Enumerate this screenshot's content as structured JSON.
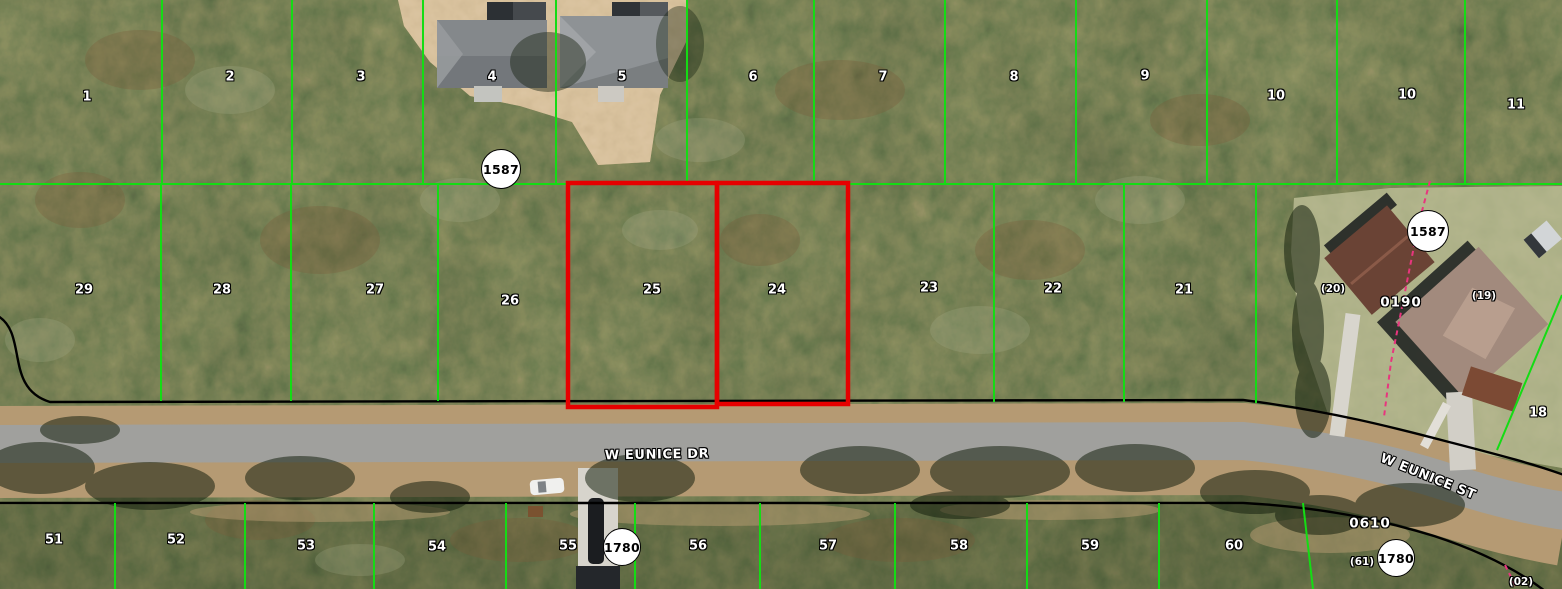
{
  "map": {
    "colors": {
      "parcel_line": "#14dc14",
      "highlight_outline": "#e60000",
      "right_of_way_line": "#000000",
      "easement_line": "#e8357e",
      "label_text": "#ffffff"
    },
    "geometry": {
      "green_lines": [
        [
          162,
          0,
          162,
          184
        ],
        [
          292,
          0,
          292,
          184
        ],
        [
          423,
          0,
          423,
          184
        ],
        [
          556,
          0,
          556,
          184
        ],
        [
          687,
          0,
          687,
          184
        ],
        [
          814,
          0,
          814,
          184
        ],
        [
          945,
          0,
          945,
          184
        ],
        [
          1076,
          0,
          1076,
          184
        ],
        [
          1207,
          0,
          1207,
          184
        ],
        [
          1337,
          0,
          1337,
          184
        ],
        [
          1465,
          0,
          1465,
          184
        ],
        [
          0,
          184,
          1562,
          184
        ],
        [
          161,
          184,
          161,
          401
        ],
        [
          291,
          184,
          291,
          401
        ],
        [
          438,
          184,
          438,
          401
        ],
        [
          994,
          184,
          994,
          402
        ],
        [
          1124,
          184,
          1124,
          402
        ],
        [
          1256,
          184,
          1256,
          403
        ],
        [
          115,
          503,
          115,
          589
        ],
        [
          245,
          503,
          245,
          589
        ],
        [
          374,
          503,
          374,
          589
        ],
        [
          506,
          503,
          506,
          589
        ],
        [
          635,
          503,
          635,
          589
        ],
        [
          760,
          503,
          760,
          589
        ],
        [
          895,
          503,
          895,
          589
        ],
        [
          1027,
          503,
          1027,
          589
        ],
        [
          1159,
          503,
          1159,
          589
        ],
        [
          1303,
          503,
          1313,
          589
        ],
        [
          1562,
          295,
          1497,
          450
        ]
      ],
      "red_parcel_outlines": [
        {
          "x": 568,
          "y": 183,
          "w": 149,
          "h": 224
        },
        {
          "x": 717,
          "y": 183,
          "w": 131,
          "h": 221
        }
      ],
      "row_lines": [
        "M -2 316 C 28 334 4 388 50 402 L 1243 400 C 1330 411 1392 427 1449 442 C 1499 455 1534 464 1564 475",
        "M 0 503 L 1243 503 C 1322 507 1382 520 1434 536 C 1480 551 1516 569 1545 591"
      ],
      "easement_lines": [
        "M 1430 181 L 1418 226 L 1403 302 L 1391 362 L 1384 417",
        "M 1505 565 L 1518 591"
      ]
    },
    "labels": [
      {
        "t": "1",
        "x": 87,
        "y": 97
      },
      {
        "t": "2",
        "x": 230,
        "y": 77
      },
      {
        "t": "3",
        "x": 361,
        "y": 77
      },
      {
        "t": "4",
        "x": 492,
        "y": 77
      },
      {
        "t": "5",
        "x": 622,
        "y": 77
      },
      {
        "t": "6",
        "x": 753,
        "y": 77
      },
      {
        "t": "7",
        "x": 883,
        "y": 77
      },
      {
        "t": "8",
        "x": 1014,
        "y": 77
      },
      {
        "t": "9",
        "x": 1145,
        "y": 76
      },
      {
        "t": "10",
        "x": 1276,
        "y": 96
      },
      {
        "t": "10",
        "x": 1407,
        "y": 95
      },
      {
        "t": "11",
        "x": 1516,
        "y": 105
      },
      {
        "t": "29",
        "x": 84,
        "y": 290
      },
      {
        "t": "28",
        "x": 222,
        "y": 290
      },
      {
        "t": "27",
        "x": 375,
        "y": 290
      },
      {
        "t": "26",
        "x": 510,
        "y": 301
      },
      {
        "t": "25",
        "x": 652,
        "y": 290
      },
      {
        "t": "24",
        "x": 777,
        "y": 290
      },
      {
        "t": "23",
        "x": 929,
        "y": 288
      },
      {
        "t": "22",
        "x": 1053,
        "y": 289
      },
      {
        "t": "21",
        "x": 1184,
        "y": 290
      },
      {
        "t": "(20)",
        "x": 1333,
        "y": 289,
        "s": "small"
      },
      {
        "t": "(19)",
        "x": 1484,
        "y": 296,
        "s": "small"
      },
      {
        "t": "18",
        "x": 1538,
        "y": 413
      },
      {
        "t": "51",
        "x": 54,
        "y": 540
      },
      {
        "t": "52",
        "x": 176,
        "y": 540
      },
      {
        "t": "53",
        "x": 306,
        "y": 546
      },
      {
        "t": "54",
        "x": 437,
        "y": 547
      },
      {
        "t": "55",
        "x": 568,
        "y": 546
      },
      {
        "t": "56",
        "x": 698,
        "y": 546
      },
      {
        "t": "57",
        "x": 828,
        "y": 546
      },
      {
        "t": "58",
        "x": 959,
        "y": 546
      },
      {
        "t": "59",
        "x": 1090,
        "y": 546
      },
      {
        "t": "60",
        "x": 1234,
        "y": 546
      },
      {
        "t": "(61)",
        "x": 1362,
        "y": 562,
        "s": "small"
      },
      {
        "t": "(02)",
        "x": 1521,
        "y": 582,
        "s": "small"
      },
      {
        "t": "0190",
        "x": 1401,
        "y": 303,
        "s": "code"
      },
      {
        "t": "0610",
        "x": 1370,
        "y": 524,
        "s": "code"
      }
    ],
    "street_labels": [
      {
        "t": "W EUNICE DR",
        "x": 657,
        "y": 455,
        "rot": -1
      },
      {
        "t": "W EUNICE ST",
        "x": 1428,
        "y": 477,
        "rot": 22
      }
    ],
    "circle_markers": [
      {
        "t": "1587",
        "x": 501,
        "y": 169,
        "r": 19
      },
      {
        "t": "1587",
        "x": 1428,
        "y": 231,
        "r": 20
      },
      {
        "t": "1780",
        "x": 622,
        "y": 547,
        "r": 18
      },
      {
        "t": "1780",
        "x": 1396,
        "y": 558,
        "r": 18
      }
    ]
  }
}
